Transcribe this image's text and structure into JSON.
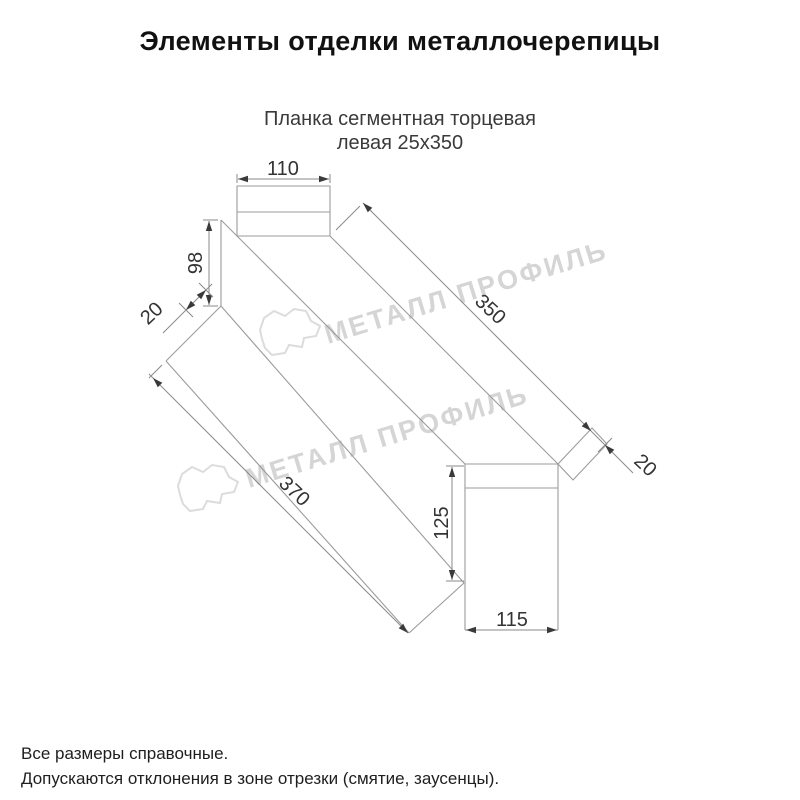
{
  "title": "Элементы отделки металлочерепицы",
  "subtitle": {
    "line1": "Планка сегментная торцевая",
    "line2": "левая 25х350"
  },
  "watermark": {
    "text": "МЕТАЛЛ ПРОФИЛЬ",
    "color": "#d5d5d5"
  },
  "drawing": {
    "dims": {
      "top_width": "110",
      "left_height": "98",
      "flange_width": "20",
      "length_top": "350",
      "hem_width": "20",
      "length_bottom": "370",
      "end_height": "125",
      "end_width": "115"
    },
    "colors": {
      "object_line": "#9b9b9b",
      "dimension_line": "#8a8a8a",
      "dimension_text": "#333333"
    }
  },
  "footer": {
    "line1": "Все размеры справочные.",
    "line2": "Допускаются отклонения в зоне отрезки (смятие, заусенцы)."
  }
}
